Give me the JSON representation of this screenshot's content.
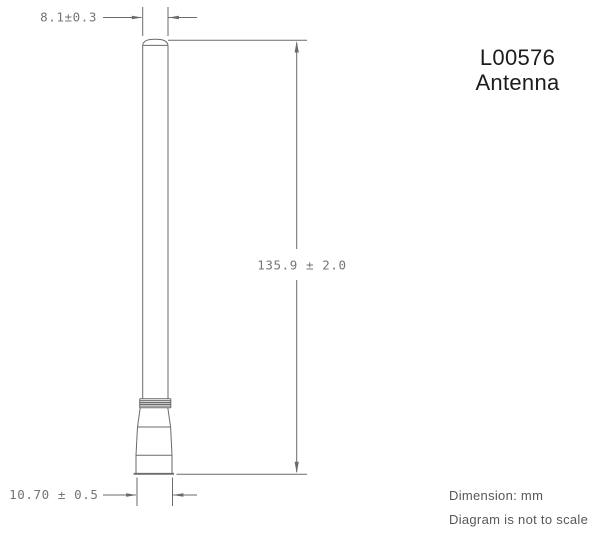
{
  "title": {
    "model": "L00576",
    "product": "Antenna"
  },
  "dimensions": {
    "top_width": "8.1±0.3",
    "height": "135.9 ± 2.0",
    "base_width": "10.70 ± 0.5"
  },
  "notes": {
    "units": "Dimension: mm",
    "scale": "Diagram is not to scale"
  },
  "colors": {
    "line": "#6a6a6a",
    "dim_text": "#757575",
    "title_text": "#1c1c1c",
    "note_text": "#55585b",
    "background": "#ffffff"
  }
}
